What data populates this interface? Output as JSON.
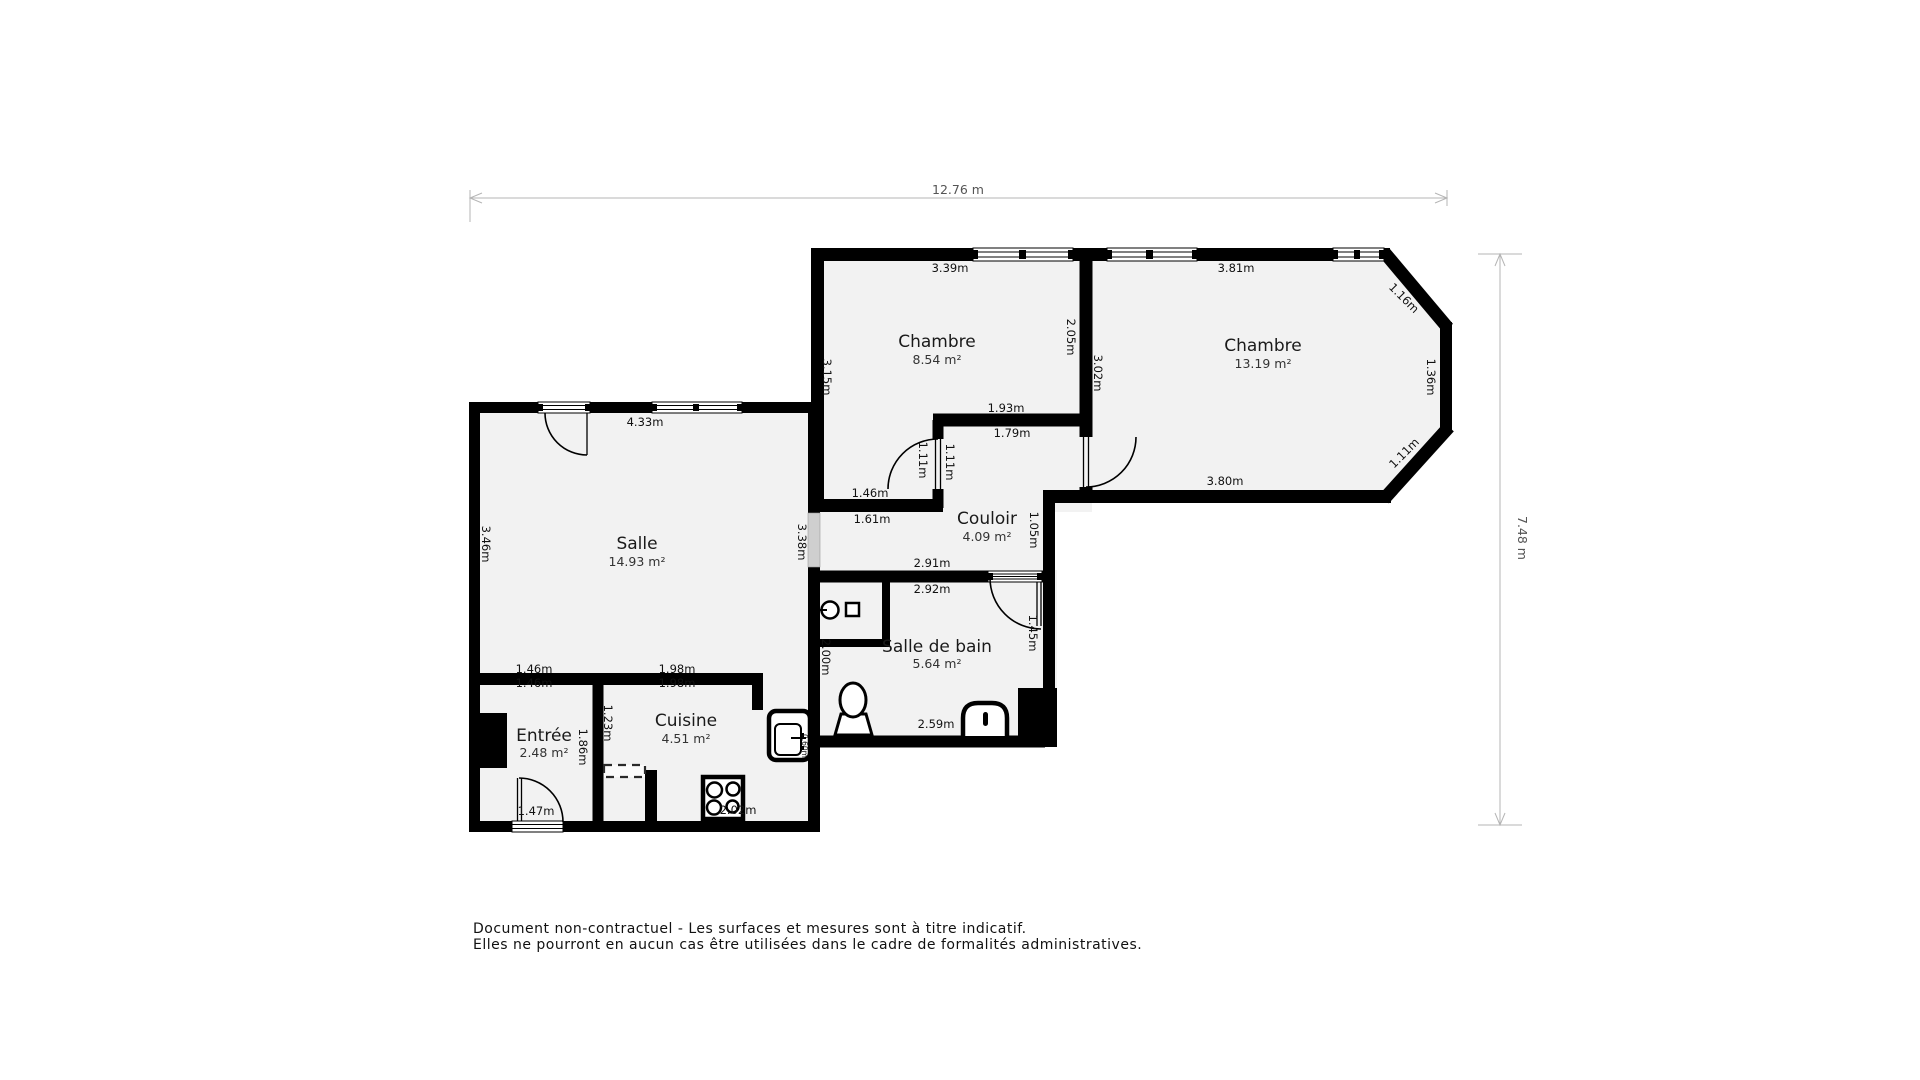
{
  "overall_dimensions": {
    "width_label": "12.76 m",
    "height_label": "7.48 m"
  },
  "rooms": [
    {
      "name": "Chambre",
      "area": "8.54 m²"
    },
    {
      "name": "Chambre",
      "area": "13.19 m²"
    },
    {
      "name": "Salle",
      "area": "14.93 m²"
    },
    {
      "name": "Couloir",
      "area": "4.09 m²"
    },
    {
      "name": "Salle de bain",
      "area": "5.64 m²"
    },
    {
      "name": "Cuisine",
      "area": "4.51 m²"
    },
    {
      "name": "Entrée",
      "area": "2.48 m²"
    }
  ],
  "dims": [
    "3.39m",
    "3.81m",
    "1.16m",
    "1.36m",
    "1.11m",
    "3.80m",
    "2.05m",
    "3.02m",
    "3.15m",
    "1.93m",
    "1.79m",
    "1.11m",
    "1.11m",
    "1.46m",
    "1.61m",
    "1.05m",
    "2.91m",
    "2.92m",
    "1.45m",
    "2.00m",
    "2.59m",
    "4.33m",
    "3.46m",
    "3.38m",
    "1.46m",
    "1.46m",
    "1.98m",
    "1.98m",
    "1.23m",
    "1.86m",
    "1.47m",
    "2.02m",
    "0.60m"
  ],
  "footer": {
    "line1": "Document non-contractuel - Les surfaces et mesures sont à titre indicatif.",
    "line2": "Elles ne pourront en aucun cas être utilisées dans le cadre de formalités administratives."
  },
  "colors": {
    "wall": "#000000",
    "room_fill": "#f2f2f2",
    "dimension_line": "#b5b5b5",
    "dimension_text": "#555555",
    "label_text": "#111111",
    "passage_fill": "#cfcfcf",
    "background": "#ffffff"
  }
}
